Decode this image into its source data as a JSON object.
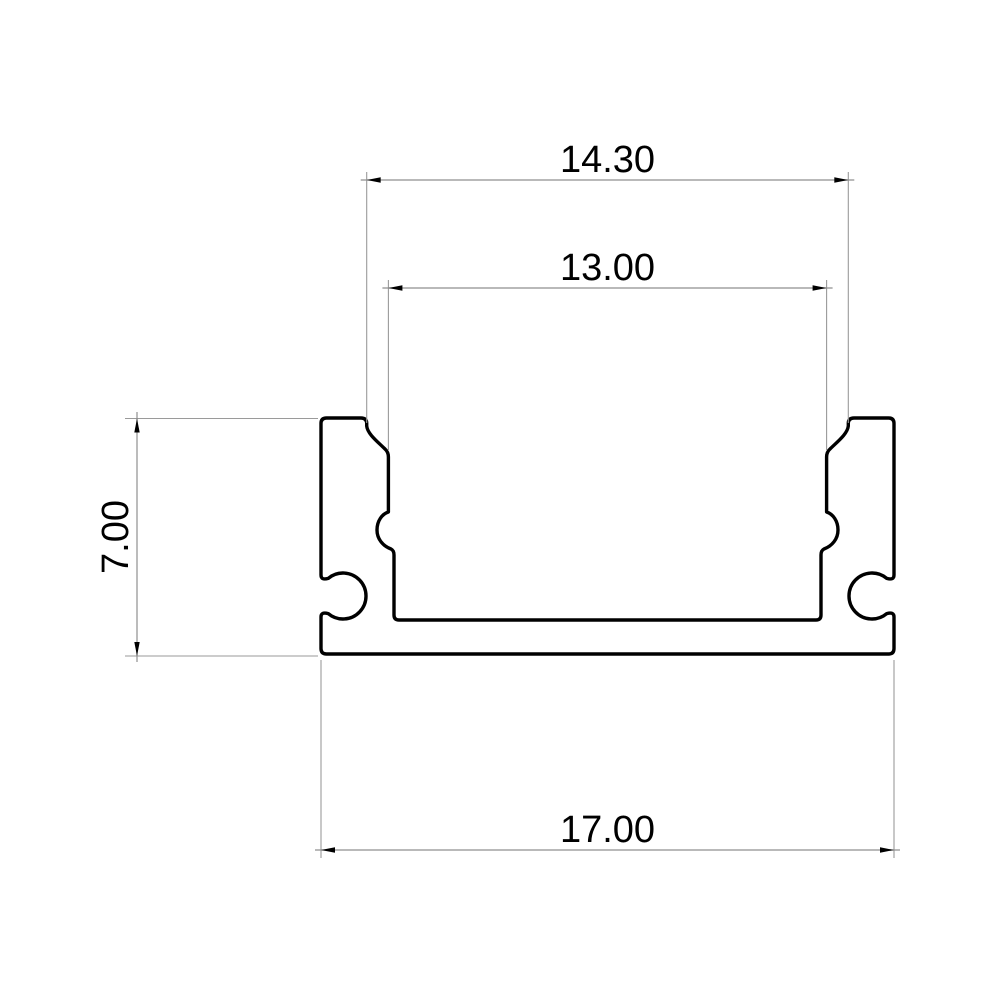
{
  "page": {
    "background_color": "#ffffff",
    "content": "technical 2D CAD cross-section drawing of an aluminum LED strip channel profile"
  },
  "drawing": {
    "subject": "led-profile-cross-section",
    "style": {
      "outline_color": "#000000",
      "dimension_line_color": "#8f8f8f",
      "text_color": "#000000"
    },
    "dimensions": [
      {
        "id": "top-outer-width",
        "label": "14.30",
        "value": 14.3,
        "orientation": "horizontal",
        "measures": "width across top flange step edges"
      },
      {
        "id": "inner-channel-width",
        "label": "13.00",
        "value": 13.0,
        "orientation": "horizontal",
        "measures": "inner channel width between side walls"
      },
      {
        "id": "overall-height",
        "label": "7.00",
        "value": 7.0,
        "orientation": "vertical",
        "measures": "overall profile height"
      },
      {
        "id": "overall-width",
        "label": "17.00",
        "value": 17.0,
        "orientation": "horizontal",
        "measures": "overall profile width at base"
      }
    ]
  }
}
